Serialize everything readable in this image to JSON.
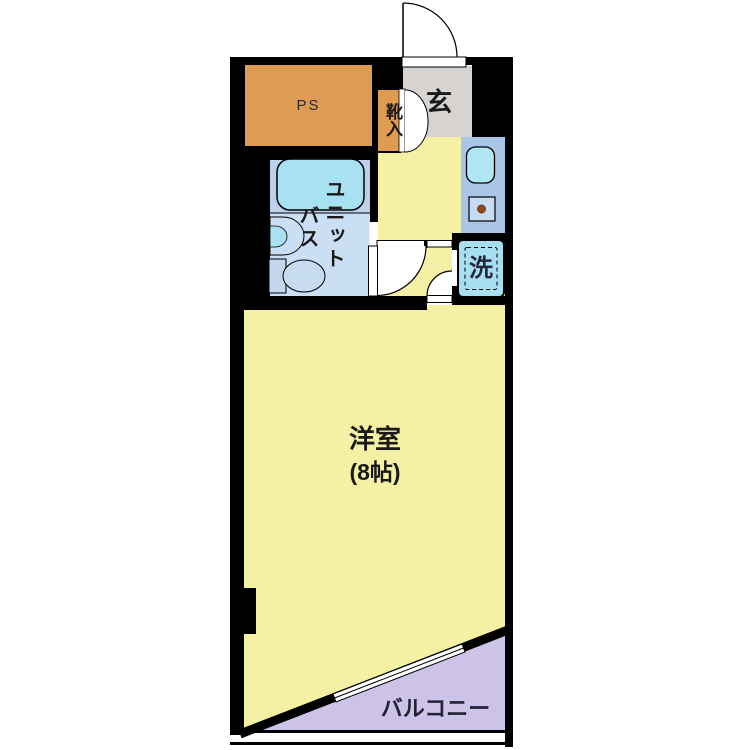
{
  "plan": {
    "rooms": {
      "ps": {
        "label": "PS"
      },
      "shoe_cabinet": {
        "label": "靴入"
      },
      "entrance": {
        "label": "玄"
      },
      "unit_bath": {
        "label_col_right": "ユニット",
        "label_col_left": "バス"
      },
      "washer": {
        "label": "洗"
      },
      "main_room": {
        "label": "洋室",
        "size": "(8帖)"
      },
      "balcony": {
        "label": "バルコニー"
      }
    },
    "colors": {
      "wall_black": "#000000",
      "room_yellow": "#F5F1A4",
      "ps_orange": "#DE9B52",
      "entrance_gray": "#D6D3D1",
      "bath_floor_blue": "#CADEF4",
      "bath_upper_blue": "#BDD1EB",
      "fixture_cyan": "#A8E2F2",
      "kitchen_counter_blue": "#A9C6E8",
      "washer_cyan": "#A8DFF0",
      "balcony_purple": "#CDC3E8",
      "stove_dot_brown": "#8B4A1E"
    }
  }
}
